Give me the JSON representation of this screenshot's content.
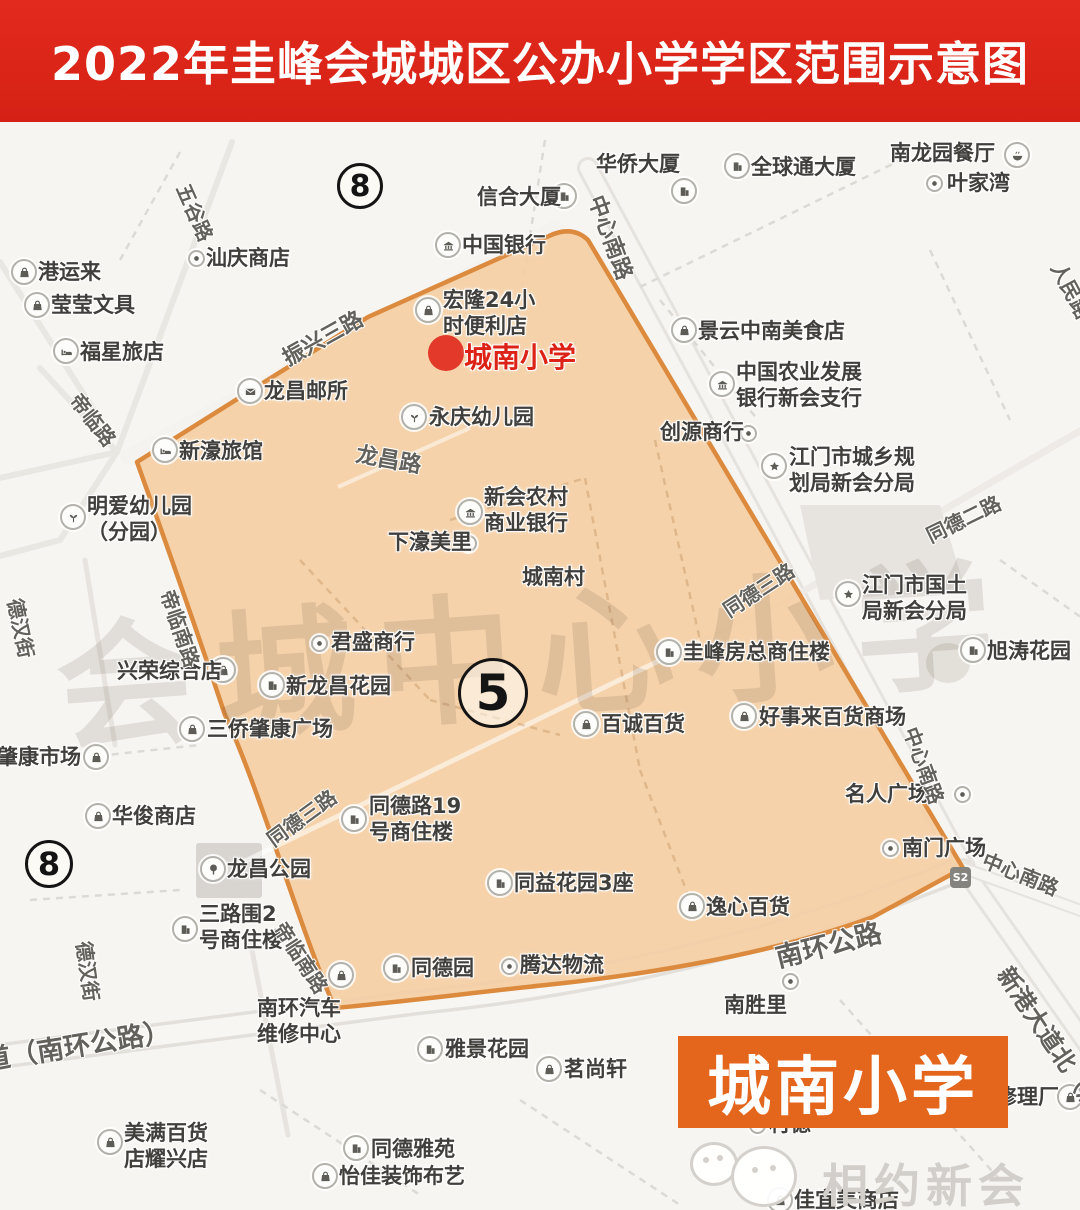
{
  "banner": {
    "title": "2022年圭峰会城城区公办小学学区范围示意图",
    "bg": "#d92b1e",
    "fg": "#ffffff"
  },
  "district_zone": {
    "number": "5",
    "fill": "#f4cfa5",
    "stroke": "#db8a3e"
  },
  "school_marker": {
    "label": "城南小学",
    "color": "#e2392b"
  },
  "footer_badge": {
    "label": "城南小学",
    "bg": "#e4661d",
    "fg": "#ffffff"
  },
  "brand_watermark": {
    "label": "相约新会",
    "icon": "wechat-logo"
  },
  "map_watermark": {
    "text": "会城中心小学"
  },
  "s2_badge": {
    "label": "S2"
  },
  "zone_numbers": [
    {
      "t": "8",
      "x": 357,
      "y": 183,
      "d": 40,
      "fs": 30
    },
    {
      "t": "8",
      "x": 46,
      "y": 861,
      "d": 42,
      "fs": 32
    },
    {
      "t": "5",
      "x": 490,
      "y": 690,
      "d": 64,
      "fs": 50
    }
  ],
  "road_labels": [
    {
      "t": "五谷路",
      "x": 196,
      "y": 212,
      "r": 66
    },
    {
      "t": "振兴三路",
      "x": 322,
      "y": 337,
      "r": -29,
      "fs": 22
    },
    {
      "t": "中心南路",
      "x": 612,
      "y": 237,
      "r": 70,
      "fs": 22
    },
    {
      "t": "帝临路",
      "x": 94,
      "y": 419,
      "r": 52
    },
    {
      "t": "龙昌路",
      "x": 389,
      "y": 458,
      "r": 10,
      "fs": 22
    },
    {
      "t": "帝临南路",
      "x": 181,
      "y": 628,
      "r": 71
    },
    {
      "t": "德汉街",
      "x": 22,
      "y": 628,
      "r": 78
    },
    {
      "t": "同德二路",
      "x": 963,
      "y": 518,
      "r": -26
    },
    {
      "t": "同德三路",
      "x": 758,
      "y": 589,
      "r": -33
    },
    {
      "t": "同德三路",
      "x": 301,
      "y": 817,
      "r": -36
    },
    {
      "t": "中心南路",
      "x": 925,
      "y": 765,
      "r": 70
    },
    {
      "t": "中心南路",
      "x": 1021,
      "y": 873,
      "r": 22
    },
    {
      "t": "南环公路",
      "x": 828,
      "y": 943,
      "r": -14,
      "fs": 27
    },
    {
      "t": "会大道（南环公路）",
      "x": 50,
      "y": 1048,
      "r": -9,
      "fs": 27
    },
    {
      "t": "新港大道北（启",
      "x": 1052,
      "y": 1038,
      "r": 56,
      "fs": 24
    },
    {
      "t": "帝临南路",
      "x": 302,
      "y": 957,
      "r": 57
    },
    {
      "t": "人民路",
      "x": 1072,
      "y": 290,
      "r": 62
    },
    {
      "t": "德汉街",
      "x": 89,
      "y": 971,
      "r": 82
    }
  ],
  "pois": [
    {
      "i": "bag",
      "ix": 24,
      "iy": 272,
      "tx": 38,
      "ty": 272,
      "lines": [
        "港运来"
      ]
    },
    {
      "i": "bag",
      "ix": 37,
      "iy": 305,
      "tx": 51,
      "ty": 305,
      "lines": [
        "莹莹文具"
      ]
    },
    {
      "i": "bed",
      "ix": 66,
      "iy": 351,
      "tx": 80,
      "ty": 352,
      "lines": [
        "福星旅店"
      ]
    },
    {
      "i": "dot",
      "ix": 196,
      "iy": 258,
      "tx": 206,
      "ty": 258,
      "lines": [
        "汕庆商店"
      ]
    },
    {
      "i": "building",
      "ix": 564,
      "iy": 196,
      "tx": 477,
      "ty": 197,
      "lines": [
        "信合大厦"
      ]
    },
    {
      "tx": 596,
      "ty": 164,
      "lines": [
        "华侨大厦"
      ]
    },
    {
      "i": "building",
      "ix": 684,
      "iy": 191
    },
    {
      "i": "building",
      "ix": 737,
      "iy": 166,
      "tx": 751,
      "ty": 167,
      "lines": [
        "全球通大厦"
      ]
    },
    {
      "i": "bowl",
      "ix": 1017,
      "iy": 155,
      "tx": 890,
      "ty": 153,
      "lines": [
        "南龙园餐厅"
      ]
    },
    {
      "i": "dot",
      "ix": 934,
      "iy": 183,
      "tx": 947,
      "ty": 183,
      "lines": [
        "叶家湾"
      ]
    },
    {
      "i": "bank",
      "ix": 448,
      "iy": 245,
      "tx": 462,
      "ty": 245,
      "lines": [
        "中国银行"
      ]
    },
    {
      "i": "bag",
      "ix": 428,
      "iy": 310,
      "tx": 443,
      "ty": 300,
      "lines": [
        "宏隆24小",
        "时便利店"
      ]
    },
    {
      "i": "kid",
      "ix": 414,
      "iy": 417,
      "tx": 429,
      "ty": 417,
      "lines": [
        "永庆幼儿园"
      ]
    },
    {
      "i": "mail",
      "ix": 250,
      "iy": 391,
      "tx": 264,
      "ty": 391,
      "lines": [
        "龙昌邮所"
      ]
    },
    {
      "i": "bed",
      "ix": 165,
      "iy": 450,
      "tx": 179,
      "ty": 451,
      "lines": [
        "新濠旅馆"
      ]
    },
    {
      "i": "kid",
      "ix": 73,
      "iy": 517,
      "tx": 87,
      "ty": 506,
      "lines": [
        "明爱幼儿园",
        "（分园）"
      ]
    },
    {
      "i": "dot",
      "ix": 748,
      "iy": 433,
      "tx": 660,
      "ty": 432,
      "lines": [
        "创源商行"
      ]
    },
    {
      "i": "bag",
      "ix": 684,
      "iy": 330,
      "tx": 698,
      "ty": 331,
      "lines": [
        "景云中南美食店"
      ]
    },
    {
      "i": "bank",
      "ix": 722,
      "iy": 384,
      "tx": 736,
      "ty": 372,
      "lines": [
        "中国农业发展",
        "银行新会支行"
      ]
    },
    {
      "i": "star",
      "ix": 774,
      "iy": 466,
      "tx": 789,
      "ty": 457,
      "lines": [
        "江门市城乡规",
        "划局新会分局"
      ]
    },
    {
      "i": "star",
      "ix": 848,
      "iy": 594,
      "tx": 862,
      "ty": 585,
      "lines": [
        "江门市国土",
        "局新会分局"
      ]
    },
    {
      "i": "building",
      "ix": 973,
      "iy": 650,
      "tx": 987,
      "ty": 651,
      "lines": [
        "旭涛花园"
      ]
    },
    {
      "i": "dot",
      "ix": 468,
      "iy": 543,
      "tx": 388,
      "ty": 542,
      "lines": [
        "下濠美里"
      ]
    },
    {
      "tx": 522,
      "ty": 577,
      "lines": [
        "城南村"
      ]
    },
    {
      "i": "bank",
      "ix": 470,
      "iy": 512,
      "tx": 484,
      "ty": 497,
      "lines": [
        "新会农村",
        "商业银行"
      ]
    },
    {
      "i": "dot",
      "ix": 319,
      "iy": 643,
      "tx": 331,
      "ty": 642,
      "lines": [
        "君盛商行"
      ]
    },
    {
      "i": "bag",
      "ix": 223,
      "iy": 670,
      "tx": 117,
      "ty": 671,
      "lines": [
        "兴荣综合店"
      ]
    },
    {
      "i": "building",
      "ix": 272,
      "iy": 685,
      "tx": 286,
      "ty": 686,
      "lines": [
        "新龙昌花园"
      ]
    },
    {
      "i": "bag",
      "ix": 192,
      "iy": 729,
      "tx": 207,
      "ty": 729,
      "lines": [
        "三侨肇康广场"
      ]
    },
    {
      "i": "bag",
      "ix": 96,
      "iy": 757,
      "tx": -45,
      "ty": 757,
      "lines": [
        "三侨肇康市场"
      ]
    },
    {
      "i": "bag",
      "ix": 98,
      "iy": 816,
      "tx": 112,
      "ty": 816,
      "lines": [
        "华俊商店"
      ]
    },
    {
      "i": "tree",
      "ix": 213,
      "iy": 869,
      "tx": 227,
      "ty": 869,
      "lines": [
        "龙昌公园"
      ]
    },
    {
      "i": "bag",
      "ix": 586,
      "iy": 724,
      "tx": 601,
      "ty": 724,
      "lines": [
        "百诚百货"
      ]
    },
    {
      "i": "bag",
      "ix": 744,
      "iy": 716,
      "tx": 759,
      "ty": 717,
      "lines": [
        "好事来百货商场"
      ]
    },
    {
      "i": "building",
      "ix": 669,
      "iy": 652,
      "tx": 683,
      "ty": 652,
      "lines": [
        "圭峰房总商住楼"
      ]
    },
    {
      "i": "building",
      "ix": 354,
      "iy": 819,
      "tx": 369,
      "ty": 806,
      "lines": [
        "同德路19",
        "号商住楼"
      ]
    },
    {
      "i": "dot",
      "ix": 962,
      "iy": 794,
      "tx": 845,
      "ty": 794,
      "lines": [
        "名人广场"
      ]
    },
    {
      "i": "dot",
      "ix": 890,
      "iy": 848,
      "tx": 902,
      "ty": 848,
      "lines": [
        "南门广场"
      ]
    },
    {
      "i": "bag",
      "ix": 692,
      "iy": 906,
      "tx": 706,
      "ty": 907,
      "lines": [
        "逸心百货"
      ]
    },
    {
      "i": "building",
      "ix": 500,
      "iy": 883,
      "tx": 514,
      "ty": 883,
      "lines": [
        "同益花园3座"
      ]
    },
    {
      "i": "building",
      "ix": 185,
      "iy": 929,
      "tx": 199,
      "ty": 914,
      "lines": [
        "三路围2",
        "号商住楼"
      ]
    },
    {
      "tx": 257,
      "ty": 1008,
      "lines": [
        "南环汽车",
        "维修中心"
      ]
    },
    {
      "i": "bag",
      "ix": 341,
      "iy": 975
    },
    {
      "i": "building",
      "ix": 396,
      "iy": 968,
      "tx": 411,
      "ty": 968,
      "lines": [
        "同德园"
      ]
    },
    {
      "i": "dot",
      "ix": 509,
      "iy": 966,
      "tx": 520,
      "ty": 965,
      "lines": [
        "腾达物流"
      ]
    },
    {
      "i": "building",
      "ix": 430,
      "iy": 1049,
      "tx": 445,
      "ty": 1049,
      "lines": [
        "雅景花园"
      ]
    },
    {
      "i": "bag",
      "ix": 549,
      "iy": 1069,
      "tx": 564,
      "ty": 1069,
      "lines": [
        "茗尚轩"
      ]
    },
    {
      "i": "building",
      "ix": 356,
      "iy": 1148,
      "tx": 371,
      "ty": 1149,
      "lines": [
        "同德雅苑"
      ]
    },
    {
      "i": "bag",
      "ix": 325,
      "iy": 1176,
      "tx": 339,
      "ty": 1176,
      "lines": [
        "怡佳装饰布艺"
      ]
    },
    {
      "i": "bag",
      "ix": 110,
      "iy": 1142,
      "tx": 124,
      "ty": 1133,
      "lines": [
        "美满百货",
        "店耀兴店"
      ]
    },
    {
      "i": "dot",
      "ix": 790,
      "iy": 981
    },
    {
      "tx": 724,
      "ty": 1005,
      "lines": [
        "南胜里"
      ]
    },
    {
      "i": "bag",
      "ix": 780,
      "iy": 1200,
      "tx": 794,
      "ty": 1200,
      "lines": [
        "佳宜美商店"
      ]
    },
    {
      "i": "bag",
      "ix": 1070,
      "iy": 1097,
      "tx": 996,
      "ty": 1097,
      "lines": [
        "修理厂"
      ]
    },
    {
      "i": "dot",
      "ix": 757,
      "iy": 1125,
      "tx": 769,
      "ty": 1124,
      "lines": [
        "村德"
      ]
    }
  ]
}
